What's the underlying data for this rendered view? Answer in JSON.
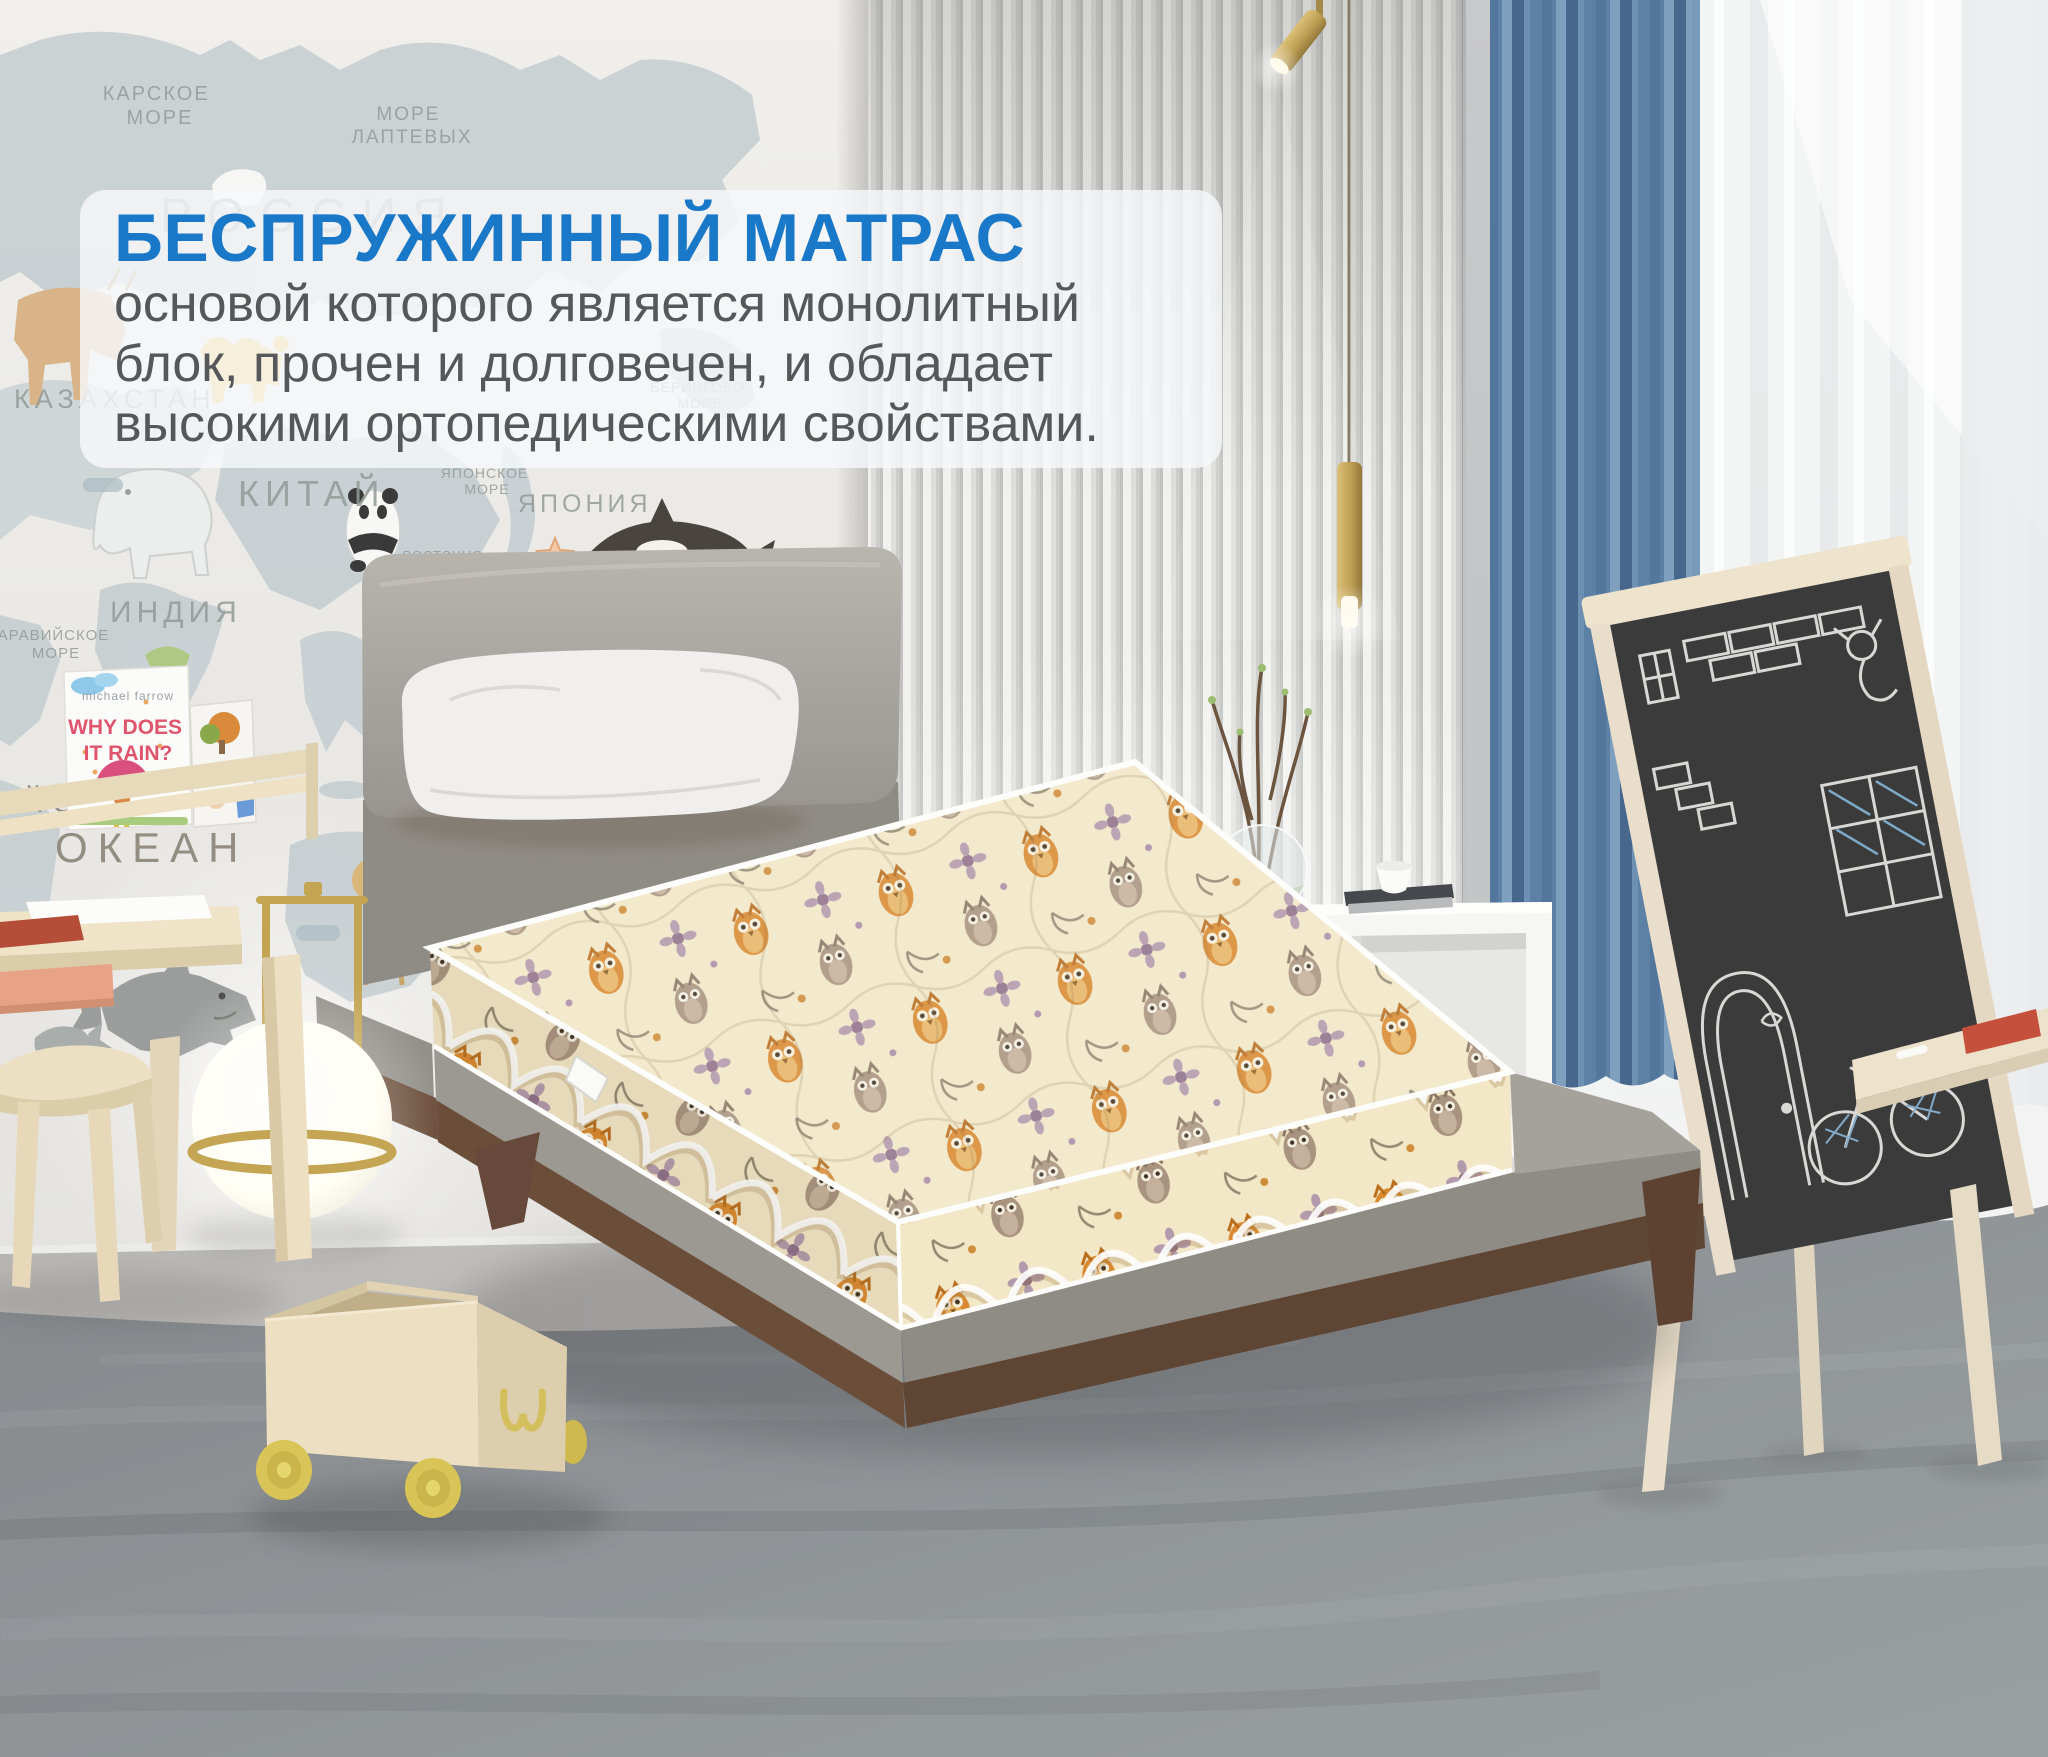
{
  "overlay": {
    "title": "БЕСПРУЖИННЫЙ МАТРАС",
    "lines": [
      "основой которого является монолитный",
      "блок, прочен и долговечен, и обладает",
      "высокими ортопедическими свойствами."
    ]
  },
  "map_labels": {
    "karskoe_l1": "КАРСКОЕ",
    "karskoe_l2": "МОРЕ",
    "laptev_l1": "МОРЕ",
    "laptev_l2": "ЛАПТЕВЫХ",
    "rossiya": "РОССИЯ",
    "kazakhstan": "КАЗАХСТАН",
    "kitay": "КИТАЙ",
    "yaponiya": "ЯПОНИЯ",
    "indiya": "ИНДИЯ",
    "aravi_l1": "АРАВИЙСКОЕ",
    "aravi_l2": "МОРЕ",
    "bering_l1": "БЕРИНГОВО",
    "bering_l2": "МОРЕ",
    "yapon_more_l1": "ЯПОНСКОЕ",
    "yapon_more_l2": "МОРЕ",
    "vost_l1": "ВОСТОЧНО-",
    "vost_l2": "КИТАЙСКОЕ",
    "vost_l3": "МОРЕ",
    "filip_l1": "ФИЛИППИНСКОЕ",
    "filip_l2": "МОРЕ",
    "tikhiy": "ТИХИЙ",
    "okean_pacific": "ОКЕАН",
    "indiysky": "ИНДИЙСКИЙ",
    "okean_indian": "ОКЕАН",
    "abc": "ABC"
  },
  "books": {
    "book1": {
      "author": "michael farrow",
      "title_l1": "WHY DOES",
      "title_l2": "IT RAIN?"
    },
    "book2": {
      "title": "gratch"
    }
  },
  "colors": {
    "accent_blue": "#1a78c8",
    "body_text": "#56575a",
    "overlay_bg": "rgba(246,248,250,0.82)",
    "map_wall": "#ebeae6",
    "continent": "#c5ced1",
    "map_label": "#939b97",
    "ocean_label": "#8a8478",
    "slat_light": "#f1f1ef",
    "slat_dark": "#c6c6c4",
    "window_wall": "#f7f8f8",
    "curtain_blue": "#5d81a5",
    "sheer_white": "#f3f4f4",
    "floor_light": "#c9c7c4",
    "carpet_gray": "#8e9294",
    "headboard_gray": "#aba6a0",
    "platform_gray": "#9c9892",
    "wood_walnut": "#6b4e3a",
    "mattress_cream": "#f2e7c6",
    "owl_orange": "#d9892f",
    "owl_taupe": "#a8937e",
    "piping_white": "#fdfdfb",
    "pillow_white": "#f1efee",
    "shelf_wood": "#e7dabb",
    "toy_wood": "#ecdfc2",
    "wheel_yellow": "#d8c457",
    "brass": "#c3a553",
    "desk_drawer_salmon": "#e8a285",
    "chalkboard": "#3b3b3b",
    "chalk": "#e9e9e7",
    "easel_wood": "#ece1cc",
    "nightstand_white": "#f6f6f5",
    "book_title_pink": "#e0556e",
    "book2_green": "#6f9c38"
  }
}
